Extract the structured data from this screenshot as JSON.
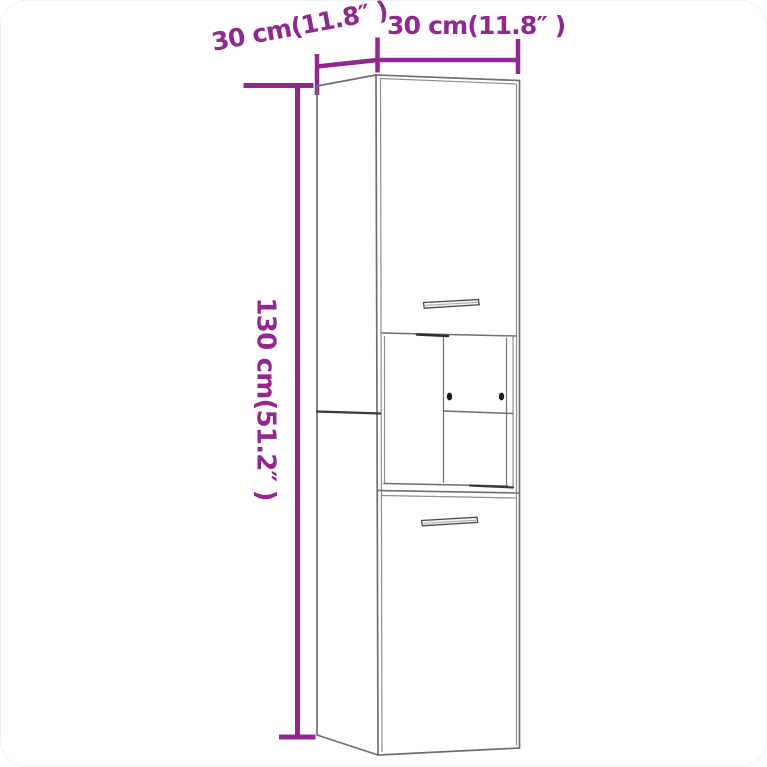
{
  "figure": {
    "kind": "furniture-dimension-diagram",
    "subject": "tall two-door wall cabinet with open middle compartment",
    "background_color": "#ffffff"
  },
  "colors": {
    "dimension_accent": "#92278F",
    "outline_gray": "#6f6f6f",
    "outline_gray_light": "#8f8f8f",
    "outline_dark": "#3a3a3a"
  },
  "dimensions": {
    "depth": {
      "label": "30 cm(11.8″ )"
    },
    "width": {
      "label": "30 cm(11.8″ )"
    },
    "height": {
      "label": "130 cm(51.2″ )"
    }
  }
}
